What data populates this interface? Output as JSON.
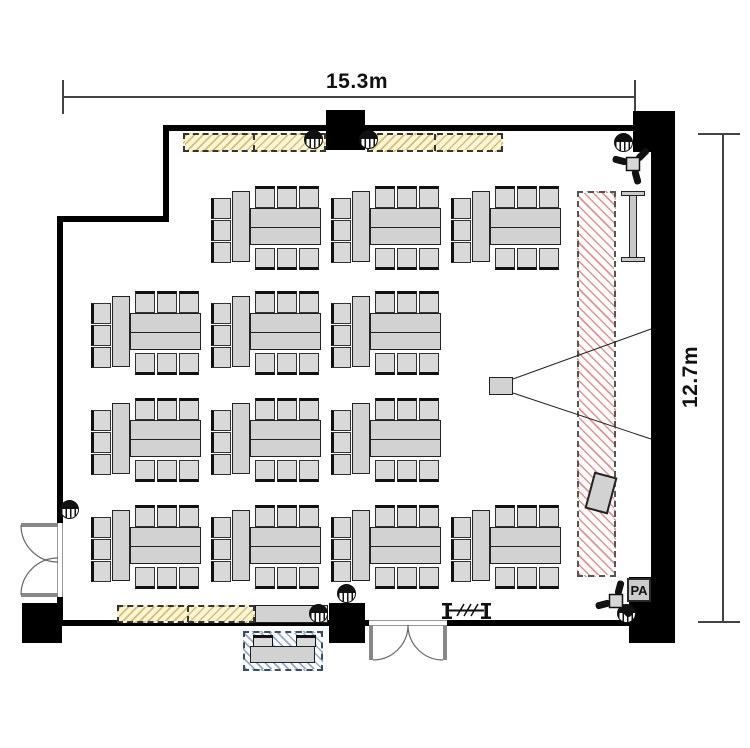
{
  "dimensions": {
    "width_label": "15.3m",
    "height_label": "12.7m"
  },
  "labels": {
    "pa": "PA"
  },
  "counts": {
    "table_groups": 13,
    "seats_per_group": 9,
    "total_seats": 117
  },
  "colors": {
    "wall": "#000000",
    "furniture_fill": "#d2d2d2",
    "chair_fill": "#d9d9d9",
    "stage_hatch": "#e06060",
    "storage_fill": "#fbf5d8",
    "storage_hatch": "#cfb460",
    "reception_hatch": "#6e8cb9",
    "dimension_line": "#444444"
  },
  "icons": {
    "light": "ceiling-light",
    "speaker": "wall-speaker",
    "screen": "projection-screen",
    "projector": "projector",
    "partition": "movable-partition",
    "podium": "podium",
    "doors": "double-swing-door"
  },
  "floor": {
    "table_groups": [
      {
        "x": 211,
        "y": 186
      },
      {
        "x": 331,
        "y": 186
      },
      {
        "x": 451,
        "y": 186
      },
      {
        "x": 91,
        "y": 291
      },
      {
        "x": 211,
        "y": 291
      },
      {
        "x": 331,
        "y": 291
      },
      {
        "x": 91,
        "y": 398
      },
      {
        "x": 211,
        "y": 398
      },
      {
        "x": 331,
        "y": 398
      },
      {
        "x": 91,
        "y": 505
      },
      {
        "x": 211,
        "y": 505
      },
      {
        "x": 331,
        "y": 505
      },
      {
        "x": 451,
        "y": 505
      }
    ],
    "lights": [
      {
        "x": 313,
        "y": 139
      },
      {
        "x": 368,
        "y": 139
      },
      {
        "x": 623,
        "y": 142
      },
      {
        "x": 69,
        "y": 509
      },
      {
        "x": 318,
        "y": 613
      },
      {
        "x": 346,
        "y": 593
      },
      {
        "x": 626,
        "y": 613
      }
    ]
  }
}
